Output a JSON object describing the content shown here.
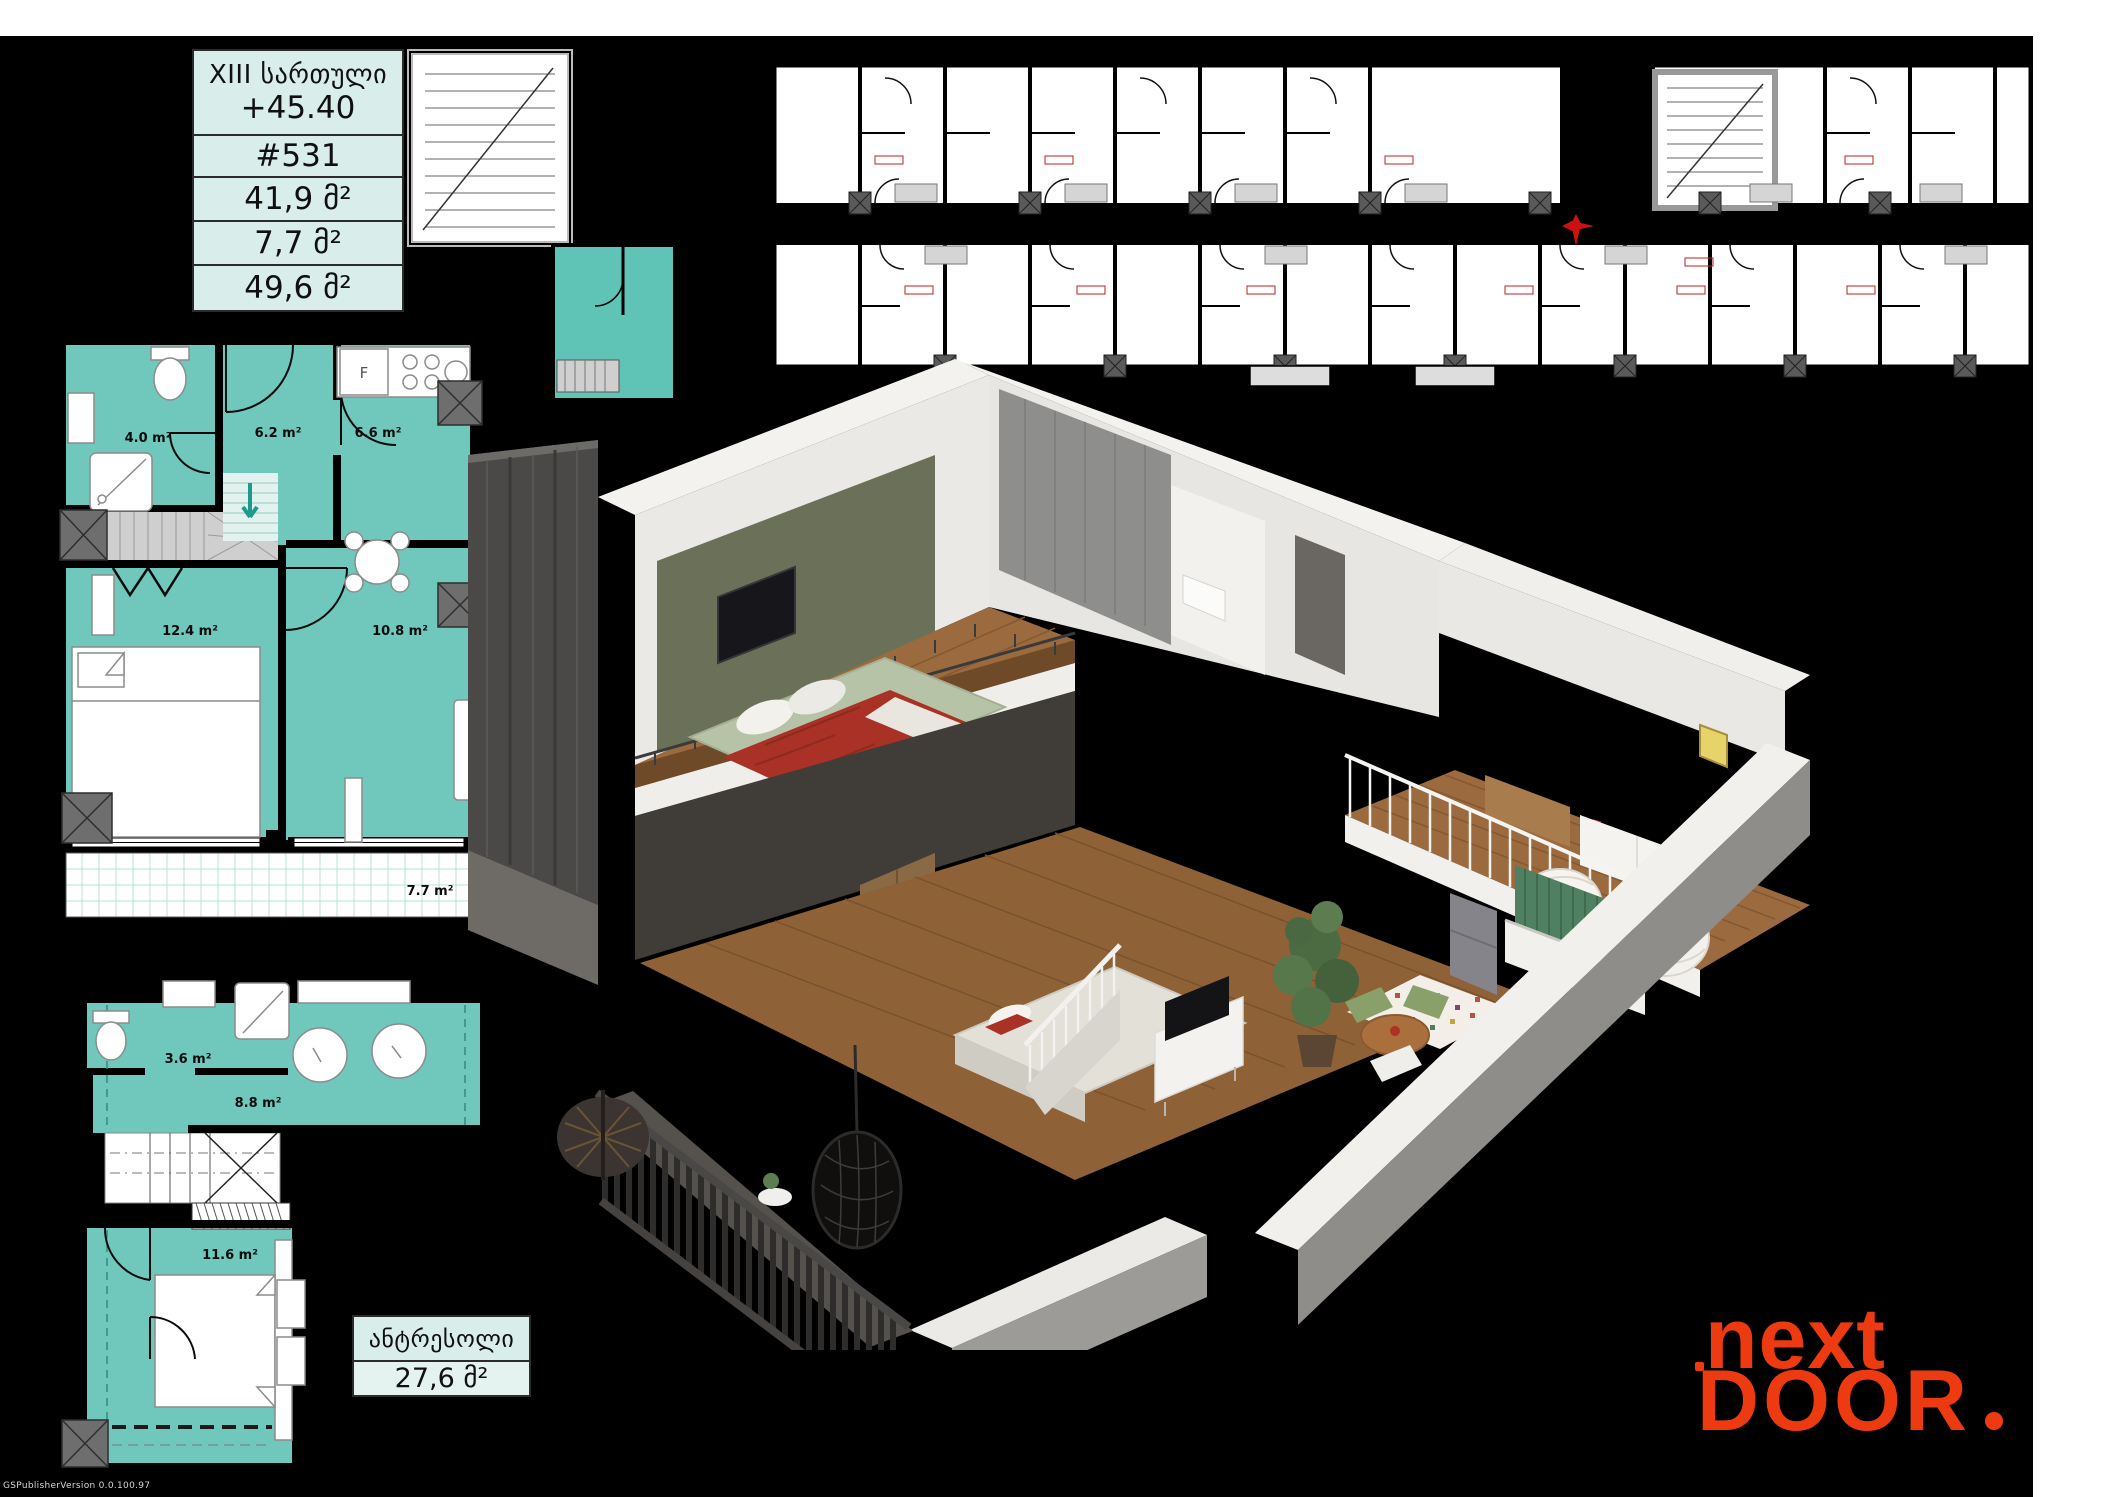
{
  "info_table": {
    "floor_label": "XIII სართული",
    "elevation": "+45.40",
    "unit_number": "#531",
    "area_living": "41,9 მ²",
    "area_balcony": "7,7 მ²",
    "area_total": "49,6 მ²"
  },
  "mezzanine_table": {
    "title": "ანტრესოლი",
    "area": "27,6 მ²"
  },
  "main_plan": {
    "room_fill": "#6fc8bb",
    "rooms": {
      "bath": "4.0 m²",
      "hall": "6.2 m²",
      "kitchen": "6.6 m²",
      "bedroom": "12.4 m²",
      "living": "10.8 m²",
      "balcony": "7.7 m²"
    },
    "fridge_label": "F"
  },
  "mezzanine_plan": {
    "rooms": {
      "bath": "3.6 m²",
      "hall": "8.8 m²",
      "bedroom": "11.6 m²"
    }
  },
  "key_plan": {
    "highlight_color": "#5fc3b6",
    "compass_color": "#cc1111"
  },
  "logo": {
    "line1": "next",
    "line2": "DOOR",
    "color": "#ee3a10"
  },
  "watermark": "GSPublisherVersion 0.0.100.97"
}
